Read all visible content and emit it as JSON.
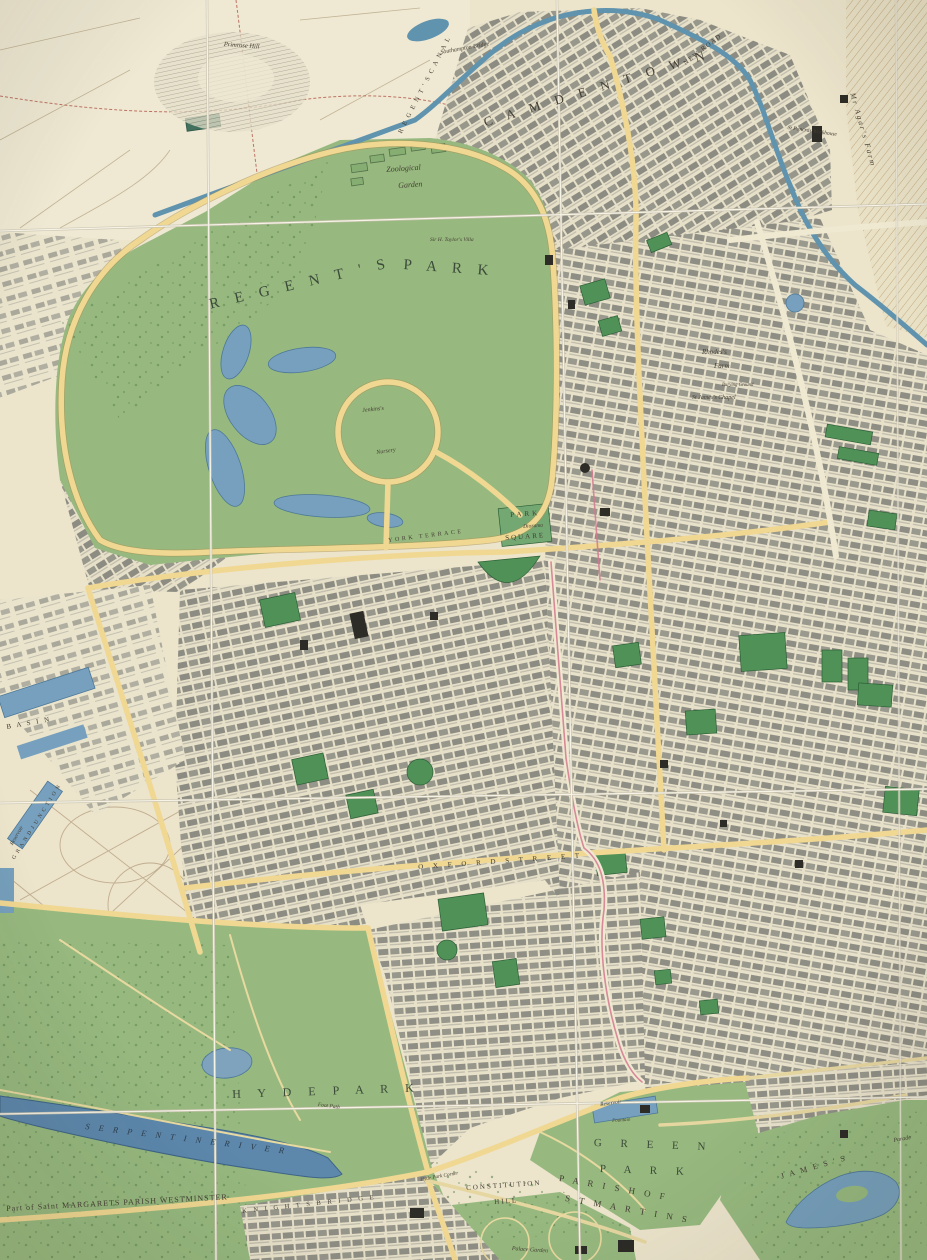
{
  "map": {
    "colors": {
      "paper": "#ece4cb",
      "field": "#efe9d3",
      "park_green": "#97b97f",
      "square_green": "#4f9156",
      "water": "#76a0bd",
      "serpentine": "#5d88ac",
      "canal": "#5f93ae",
      "road_yellow": "#f0d892",
      "built_grey": "#94938a",
      "fold_line": "#f6f3e7",
      "ink": "#443e33",
      "route_pink": "#d4798f",
      "boundary_red": "#b05548"
    },
    "labels": [
      {
        "name": "label-camden-town",
        "text": "C A M D E N   T O W N",
        "x": 482,
        "y": 116,
        "rot": -17,
        "size": 13,
        "ls": 6
      },
      {
        "name": "label-new-road",
        "text": "NEW ROAD",
        "x": 683,
        "y": 62,
        "rot": -38,
        "size": 6.5,
        "ls": 1.5
      },
      {
        "name": "label-regents-canal",
        "text": "R E G E N T ' S   C A N A L",
        "x": 398,
        "y": 132,
        "rot": -63,
        "size": 6.5,
        "ls": 1.5
      },
      {
        "name": "label-southampton-bridge",
        "text": "Southampton Bridge",
        "x": 440,
        "y": 50,
        "rot": -10,
        "size": 6,
        "it": true
      },
      {
        "name": "label-agars-farm",
        "text": "Mr Agar's Farm",
        "x": 856,
        "y": 92,
        "rot": 74,
        "size": 7.5,
        "ls": 2,
        "it": true
      },
      {
        "name": "label-pancras-workhouse",
        "text": "St Pancras Workhouse",
        "x": 788,
        "y": 126,
        "rot": 8,
        "size": 5.5,
        "it": true
      },
      {
        "name": "label-primrose-hill",
        "text": "Primrose Hill",
        "x": 224,
        "y": 42,
        "rot": 4,
        "size": 6.5,
        "it": true
      },
      {
        "name": "label-regents",
        "text": "R E G E N T ' S",
        "x": 208,
        "y": 298,
        "rot": -13,
        "size": 15,
        "ls": 6,
        "color": "#3c4a3a"
      },
      {
        "name": "label-park",
        "text": "P A R K",
        "x": 404,
        "y": 258,
        "rot": 4,
        "size": 15,
        "ls": 6,
        "color": "#3c4a3a"
      },
      {
        "name": "label-zoological",
        "text": "Zoological",
        "x": 386,
        "y": 166,
        "rot": -4,
        "size": 8,
        "it": true
      },
      {
        "name": "label-garden",
        "text": "Garden",
        "x": 398,
        "y": 182,
        "rot": -4,
        "size": 8,
        "it": true
      },
      {
        "name": "label-taylors-villa",
        "text": "Sir H. Taylor's Villa",
        "x": 430,
        "y": 238,
        "rot": 0,
        "size": 5.5,
        "it": true
      },
      {
        "name": "label-jenkinss",
        "text": "Jenkins's",
        "x": 362,
        "y": 408,
        "rot": -6,
        "size": 6,
        "it": true
      },
      {
        "name": "label-nursery",
        "text": "Nursery",
        "x": 376,
        "y": 450,
        "rot": -8,
        "size": 6,
        "it": true
      },
      {
        "name": "label-york-terrace",
        "text": "YORK TERRACE",
        "x": 388,
        "y": 538,
        "rot": -7,
        "size": 6,
        "ls": 2.5
      },
      {
        "name": "label-park-square-1",
        "text": "PARK",
        "x": 510,
        "y": 512,
        "rot": -4,
        "size": 7,
        "ls": 3
      },
      {
        "name": "label-diorama",
        "text": "Diorama",
        "x": 523,
        "y": 525,
        "rot": -4,
        "size": 5.5,
        "it": true
      },
      {
        "name": "label-park-square-2",
        "text": "SQUARE",
        "x": 505,
        "y": 535,
        "rot": -4,
        "size": 7,
        "ls": 2
      },
      {
        "name": "label-rhodes-farm-1",
        "text": "Rhodes's",
        "x": 702,
        "y": 349,
        "rot": 0,
        "size": 7,
        "it": true
      },
      {
        "name": "label-rhodes-farm-2",
        "text": "Farm",
        "x": 714,
        "y": 363,
        "rot": 0,
        "size": 7,
        "it": true
      },
      {
        "name": "label-st-james-chapel",
        "text": "St James's Chapel",
        "x": 692,
        "y": 395,
        "rot": 0,
        "size": 6,
        "it": true
      },
      {
        "name": "label-burying-ground",
        "text": "Burying Ground",
        "x": 722,
        "y": 384,
        "rot": 0,
        "size": 4.8,
        "it": true
      },
      {
        "name": "label-basin",
        "text": "B A S I N",
        "x": 6,
        "y": 724,
        "rot": -10,
        "size": 7,
        "ls": 2
      },
      {
        "name": "label-reservoir-west",
        "text": "Reservoir",
        "x": 10,
        "y": 844,
        "rot": -60,
        "size": 5.5,
        "it": true
      },
      {
        "name": "label-grand-junction",
        "text": "G R A N D   J U N C T I O N",
        "x": 12,
        "y": 858,
        "rot": -58,
        "size": 5.5,
        "ls": 1
      },
      {
        "name": "label-oxford-street",
        "text": "O X F O R D   S T R E E T",
        "x": 418,
        "y": 864,
        "rot": -4,
        "size": 7,
        "ls": 4,
        "color": "#3b3b33"
      },
      {
        "name": "label-hyde-park",
        "text": "H Y D E    P A R K",
        "x": 232,
        "y": 1088,
        "rot": -2,
        "size": 12,
        "ls": 7,
        "color": "#3c4a3a"
      },
      {
        "name": "label-foot-path",
        "text": "Foot Path",
        "x": 318,
        "y": 1103,
        "rot": 7,
        "size": 5.5,
        "it": true
      },
      {
        "name": "label-serpentine-river",
        "text": "S E R P E N T I N E   R I V E R",
        "x": 86,
        "y": 1122,
        "rot": 7,
        "size": 8.5,
        "ls": 3.5,
        "it": true,
        "color": "#2c3e4c"
      },
      {
        "name": "label-green",
        "text": "G R E E N",
        "x": 594,
        "y": 1138,
        "rot": 2,
        "size": 11,
        "ls": 8,
        "color": "#3c4a3a"
      },
      {
        "name": "label-green-park",
        "text": "P A R K",
        "x": 600,
        "y": 1164,
        "rot": 2,
        "size": 11,
        "ls": 8,
        "color": "#3c4a3a"
      },
      {
        "name": "label-reservoir-green-park",
        "text": "Reservoir",
        "x": 600,
        "y": 1103,
        "rot": -8,
        "size": 5.5,
        "it": true,
        "color": "#23323c"
      },
      {
        "name": "label-fountain",
        "text": "Fountain",
        "x": 612,
        "y": 1119,
        "rot": -4,
        "size": 5,
        "it": true
      },
      {
        "name": "label-parish-of",
        "text": "P A R I S H   O F",
        "x": 560,
        "y": 1174,
        "rot": 10,
        "size": 9,
        "ls": 3.5
      },
      {
        "name": "label-st-martins",
        "text": "S T   M A R T I N S",
        "x": 566,
        "y": 1194,
        "rot": 10,
        "size": 9,
        "ls": 3.5
      },
      {
        "name": "label-constitution",
        "text": "CONSTITUTION",
        "x": 466,
        "y": 1185,
        "rot": -4,
        "size": 7,
        "ls": 2
      },
      {
        "name": "label-hill",
        "text": "HILL",
        "x": 494,
        "y": 1199,
        "rot": -4,
        "size": 7,
        "ls": 2
      },
      {
        "name": "label-hyde-park-corner",
        "text": "Hyde Park Corner",
        "x": 420,
        "y": 1178,
        "rot": -10,
        "size": 5.2,
        "it": true
      },
      {
        "name": "label-palace-garden",
        "text": "Palace Garden",
        "x": 512,
        "y": 1246,
        "rot": 4,
        "size": 6,
        "it": true
      },
      {
        "name": "label-st-margarets",
        "text": "Part of Saint MARGARETS PARISH WESTMINSTER",
        "x": 6,
        "y": 1205,
        "rot": -3,
        "size": 8,
        "ls": 1
      },
      {
        "name": "label-knightsbridge",
        "text": "K N I G H T S B R I D G E",
        "x": 242,
        "y": 1209,
        "rot": -6,
        "size": 6.5,
        "ls": 2.5
      },
      {
        "name": "label-st-jamess-park",
        "text": "J A M E S ' S",
        "x": 780,
        "y": 1173,
        "rot": -16,
        "size": 8,
        "ls": 2
      },
      {
        "name": "label-parade",
        "text": "Parade",
        "x": 893,
        "y": 1138,
        "rot": -10,
        "size": 6,
        "it": true
      }
    ]
  }
}
